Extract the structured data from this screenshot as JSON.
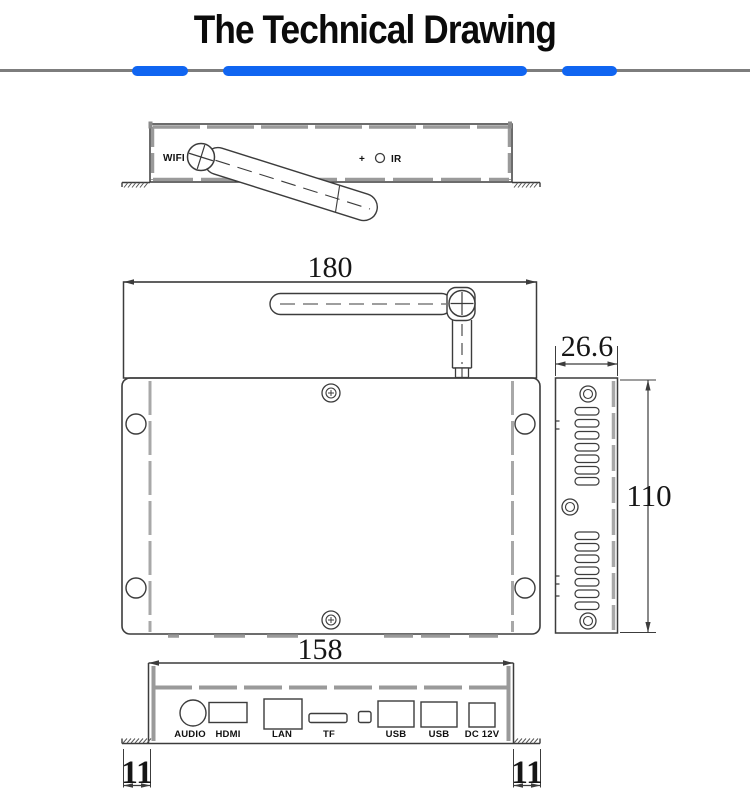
{
  "page": {
    "title": "The Technical Drawing"
  },
  "accent": {
    "divider_blue": "#1065f1",
    "divider_gray": "#7d7d7d",
    "drawing_line": "#3c3c3c",
    "drawing_gray": "#9a9a9a"
  },
  "top_view": {
    "wifi_label": "WIFI",
    "plus_symbol": "+",
    "ir_label": "IR"
  },
  "dimensions": {
    "top_width": "180",
    "side_depth": "26.6",
    "side_height": "110",
    "bottom_width": "158",
    "flange_left": "11",
    "flange_right": "11"
  },
  "back_panel": {
    "ports": [
      "AUDIO",
      "HDMI",
      "LAN",
      "TF",
      "USB",
      "USB",
      "DC 12V"
    ]
  }
}
